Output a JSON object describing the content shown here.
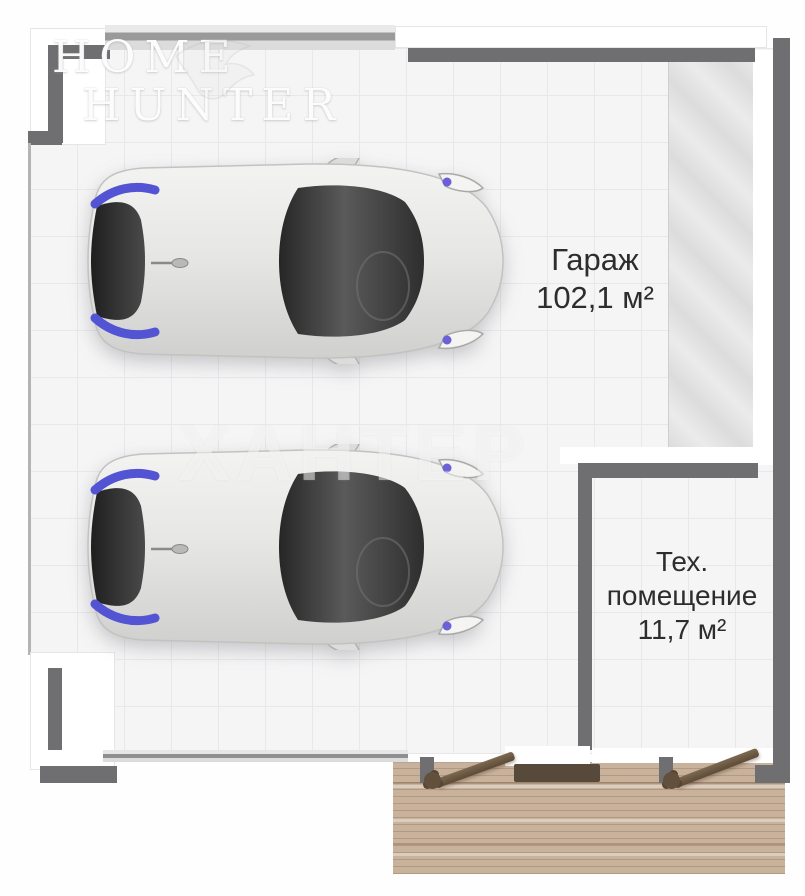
{
  "plan": {
    "title_watermark": {
      "line1": "HOME",
      "line2": "HUNTER"
    },
    "center_watermark": "ХАНТЕР",
    "rooms": [
      {
        "id": "garage",
        "name": "Гараж",
        "area": "102,1 м²"
      },
      {
        "id": "tech",
        "name": "Тех. помещение",
        "area": "11,7 м²"
      }
    ],
    "colors": {
      "wall": "#6f6f71",
      "floor_tile": "#f5f5f6",
      "tile_line": "#e8e8ea",
      "deck_wood": "#c8b29c",
      "door_wood": "#6b5844",
      "accent_blue": "#5254d4",
      "ramp_gray": "#dddddd",
      "text": "#2d2d2d"
    }
  }
}
